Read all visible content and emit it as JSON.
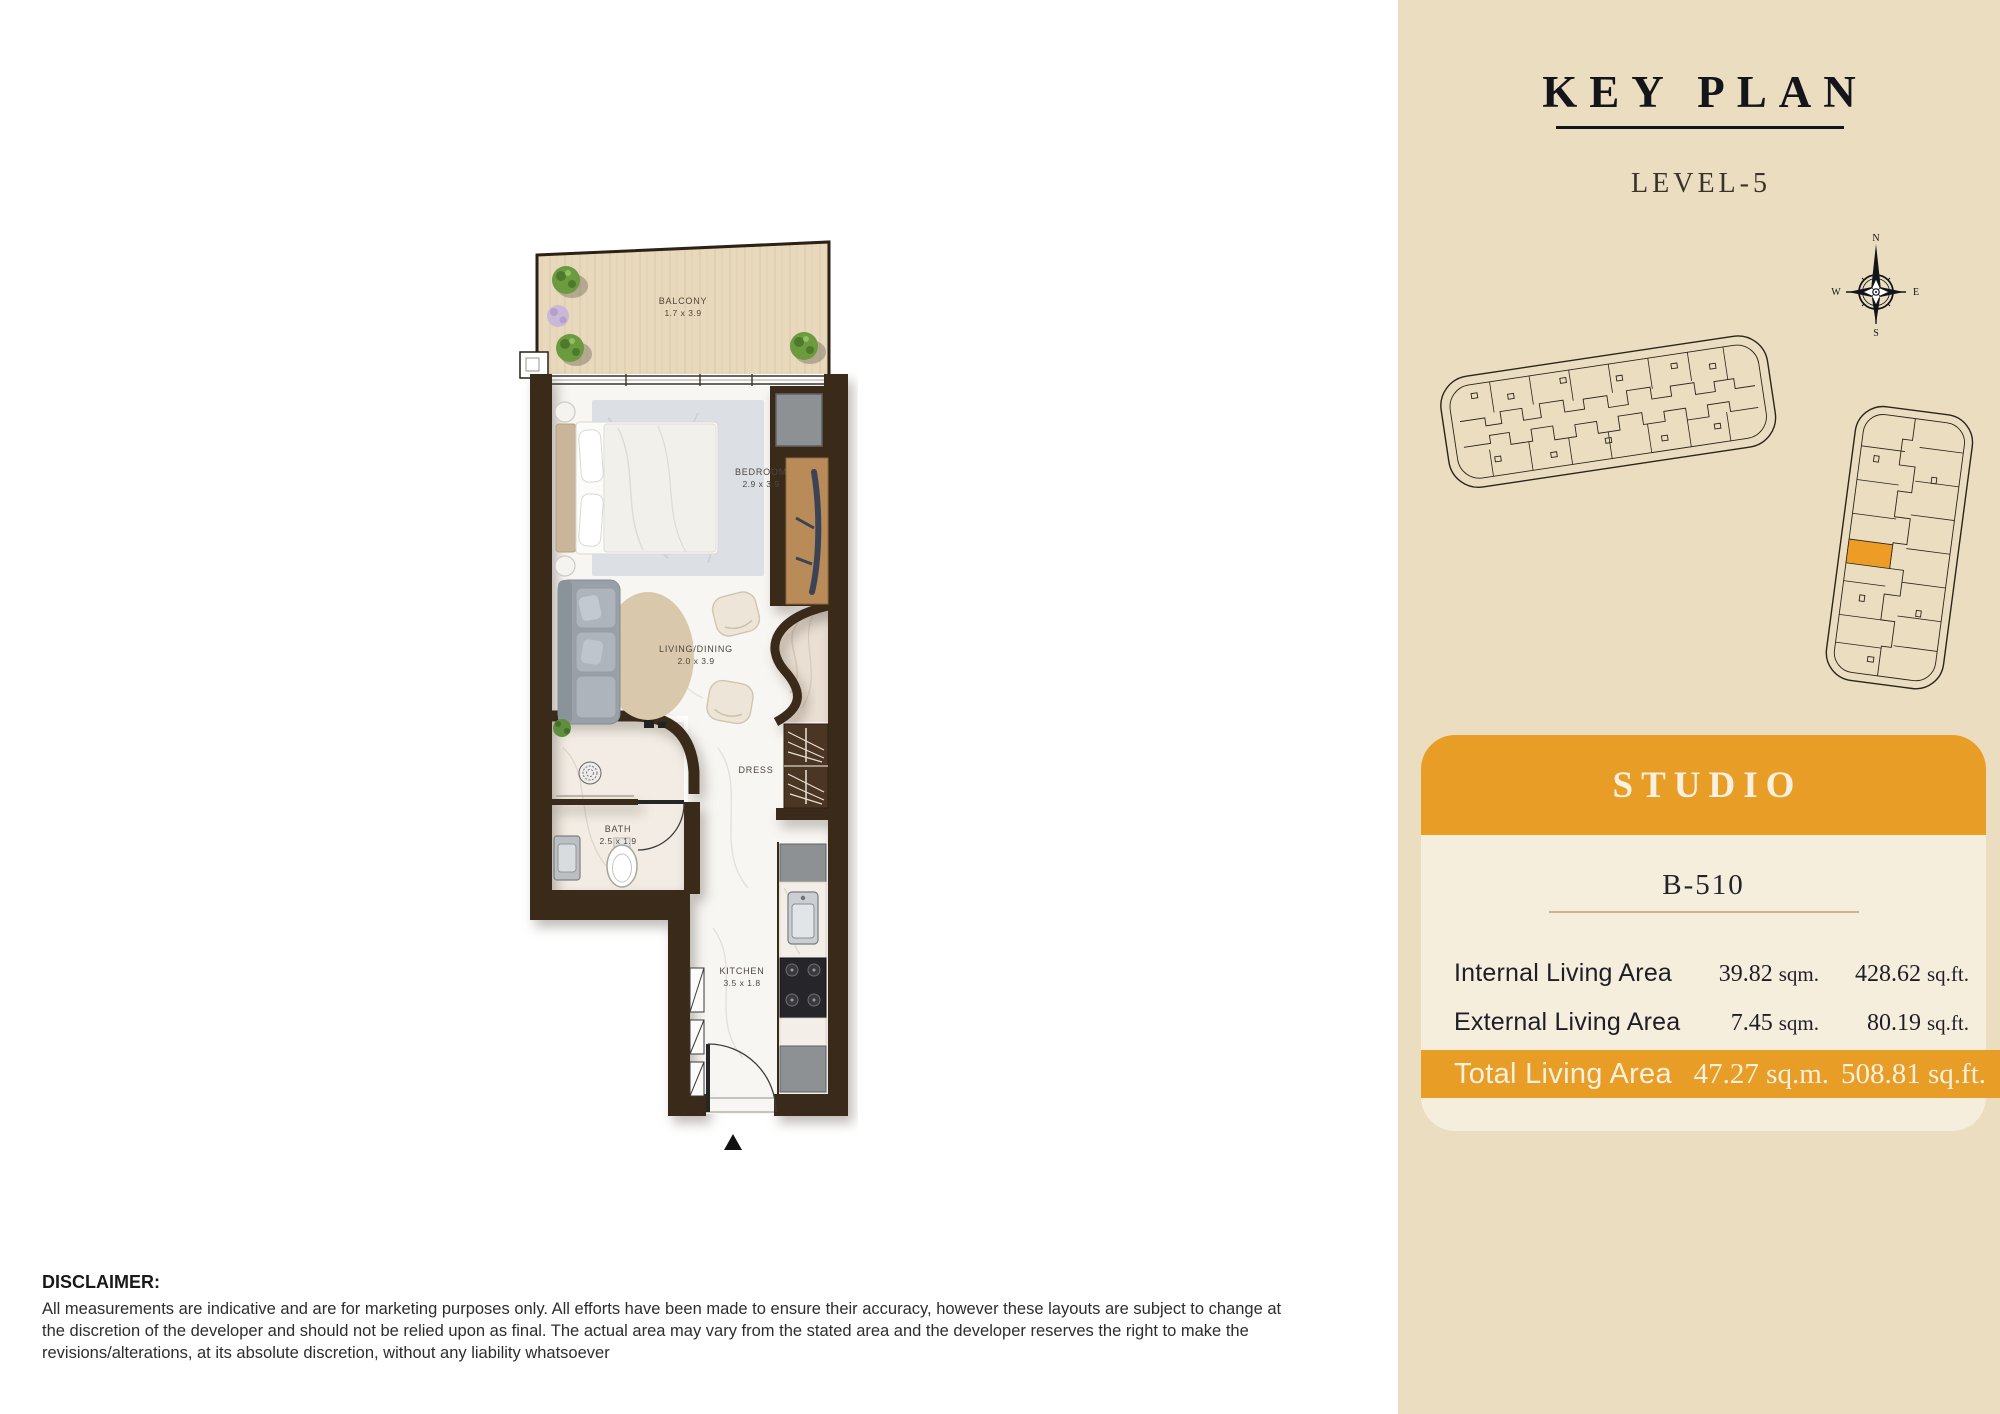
{
  "floor_plan": {
    "rooms": {
      "balcony": {
        "name": "BALCONY",
        "dims": "1.7 x 3.9"
      },
      "bedroom": {
        "name": "BEDROOM",
        "dims": "2.9 x 3.9"
      },
      "living": {
        "name": "LIVING/DINING",
        "dims": "2.0 x 3.9"
      },
      "dress": {
        "name": "DRESS"
      },
      "bath": {
        "name": "BATH",
        "dims": "2.5 x 1.9"
      },
      "kitchen": {
        "name": "KITCHEN",
        "dims": "3.5 x 1.8"
      }
    }
  },
  "key_plan": {
    "title": "KEY PLAN",
    "level": "LEVEL-5",
    "compass": {
      "n": "N",
      "e": "E",
      "s": "S",
      "w": "W"
    }
  },
  "unit_card": {
    "type": "STUDIO",
    "unit_no": "B-510",
    "rows": [
      {
        "label": "Internal Living Area",
        "sqm": "39.82",
        "sqm_unit": "sqm.",
        "sqft": "428.62",
        "sqft_unit": "sq.ft."
      },
      {
        "label": "External Living Area",
        "sqm": "7.45",
        "sqm_unit": "sqm.",
        "sqft": "80.19",
        "sqft_unit": "sq.ft."
      }
    ],
    "total": {
      "label": "Total Living Area",
      "sqm": "47.27",
      "sqm_unit": "sq.m.",
      "sqft": "508.81",
      "sqft_unit": "sq.ft."
    }
  },
  "disclaimer": {
    "title": "DISCLAIMER:",
    "body": "All measurements are indicative and are for marketing purposes only. All efforts have been made to ensure their accuracy, however these layouts are subject to change at the discretion of the developer and should not be relied upon as final. The actual area may vary from the stated area and the developer reserves the right to make the revisions/alterations, at its absolute discretion, without any liability whatsoever"
  },
  "colors": {
    "accent_orange": "#E89D26",
    "panel_beige": "#EBDDC0",
    "card_cream": "#F6EEDD",
    "wall_brown": "#3A2A1A",
    "balcony_wood": "#E8D8BC",
    "ink": "#14141B"
  }
}
